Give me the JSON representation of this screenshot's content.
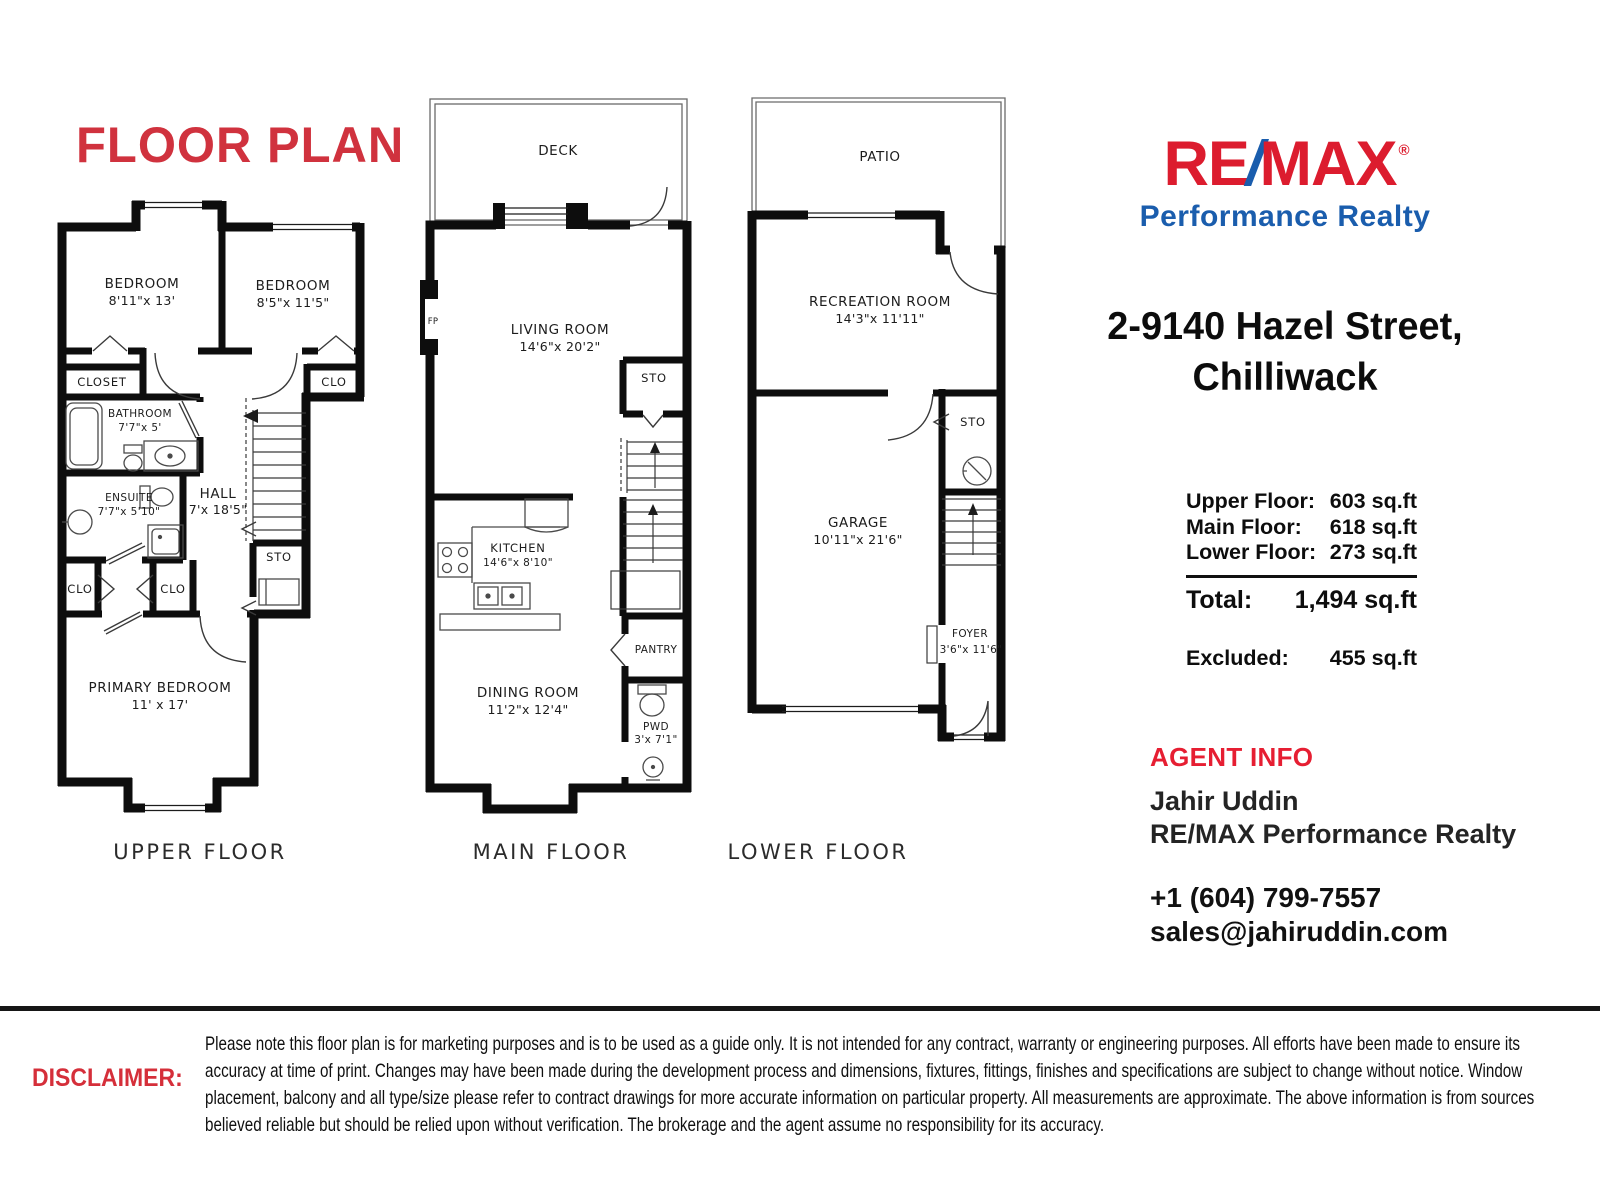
{
  "page_title": "FLOOR PLAN",
  "colors": {
    "title_red": "#d0323e",
    "remax_red": "#dc1c2e",
    "remax_blue": "#1a5dad",
    "agent_red": "#e61e32",
    "disclaimer_red": "#d52f3a",
    "wall_black": "#0d0d0d"
  },
  "floors": {
    "upper": {
      "label": "UPPER FLOOR",
      "rooms": {
        "bedroom1": {
          "name": "BEDROOM",
          "dims": "8'11\"x 13'"
        },
        "bedroom2": {
          "name": "BEDROOM",
          "dims": "8'5\"x 11'5\""
        },
        "closet": {
          "name": "CLOSET"
        },
        "clo_right": {
          "name": "CLO"
        },
        "bathroom": {
          "name": "BATHROOM",
          "dims": "7'7\"x 5'"
        },
        "ensuite": {
          "name": "ENSUITE",
          "dims": "7'7\"x 5'10\""
        },
        "hall": {
          "name": "HALL",
          "dims": "7'x 18'5\""
        },
        "sto": {
          "name": "STO"
        },
        "clo_left": {
          "name": "CLO"
        },
        "clo_mid": {
          "name": "CLO"
        },
        "primary": {
          "name": "PRIMARY BEDROOM",
          "dims": "11' x 17'"
        }
      }
    },
    "main": {
      "label": "MAIN FLOOR",
      "rooms": {
        "deck": {
          "name": "DECK"
        },
        "living": {
          "name": "LIVING ROOM",
          "dims": "14'6\"x 20'2\""
        },
        "fp": {
          "name": "FP"
        },
        "sto": {
          "name": "STO"
        },
        "kitchen": {
          "name": "KITCHEN",
          "dims": "14'6\"x 8'10\""
        },
        "pantry": {
          "name": "PANTRY"
        },
        "dining": {
          "name": "DINING ROOM",
          "dims": "11'2\"x 12'4\""
        },
        "pwd": {
          "name": "PWD",
          "dims": "3'x 7'1\""
        }
      }
    },
    "lower": {
      "label": "LOWER FLOOR",
      "rooms": {
        "patio": {
          "name": "PATIO"
        },
        "rec": {
          "name": "RECREATION ROOM",
          "dims": "14'3\"x 11'11\""
        },
        "sto": {
          "name": "STO"
        },
        "garage": {
          "name": "GARAGE",
          "dims": "10'11\"x 21'6\""
        },
        "foyer": {
          "name": "FOYER",
          "dims": "3'6\"x 11'6\""
        }
      }
    }
  },
  "brand": {
    "word_re": "RE",
    "slash": "/",
    "word_max": "MAX",
    "registered": "®",
    "tagline": "Performance Realty"
  },
  "listing": {
    "address_line1": "2-9140 Hazel Street,",
    "address_line2": "Chilliwack"
  },
  "areas": {
    "rows": [
      {
        "label": "Upper Floor:",
        "value": "603 sq.ft"
      },
      {
        "label": "Main Floor:",
        "value": "618 sq.ft"
      },
      {
        "label": "Lower Floor:",
        "value": "273 sq.ft"
      }
    ],
    "total_label": "Total:",
    "total_value": "1,494 sq.ft",
    "excluded_label": "Excluded:",
    "excluded_value": "455 sq.ft"
  },
  "agent": {
    "heading": "AGENT INFO",
    "name": "Jahir Uddin",
    "company": "RE/MAX Performance Realty",
    "phone": "+1 (604) 799-7557",
    "email": "sales@jahiruddin.com"
  },
  "disclaimer": {
    "heading": "DISCLAIMER:",
    "text": "Please note this floor plan is for marketing purposes and is to be used as a guide only. It is not intended for any contract, warranty or engineering purposes. All efforts have been made to ensure its accuracy at time of print. Changes may have been made during the development process and dimensions, fixtures, fittings, finishes and specifications are subject to change without notice. Window placement, balcony and all type/size please refer to contract drawings for more accurate information on particular property. All measurements are approximate. The above information is from sources believed reliable but should be relied upon without verification. The brokerage and the agent assume no responsibility for its accuracy."
  }
}
